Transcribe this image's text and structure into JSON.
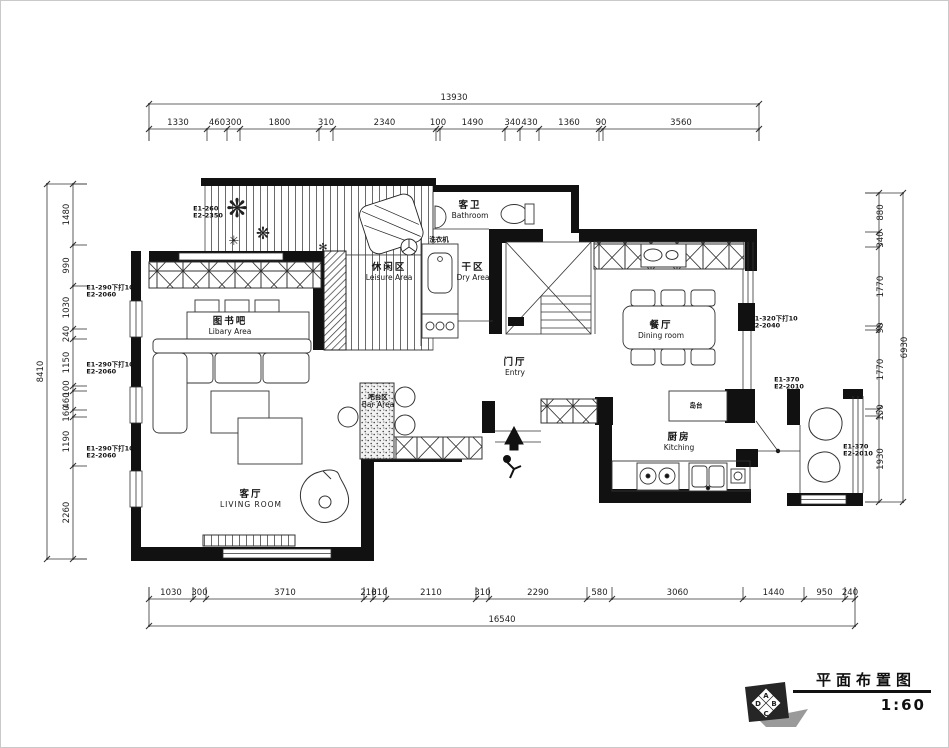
{
  "title_block": {
    "title": "平面布置图",
    "scale_label": "1:60",
    "logo_letters": {
      "top": "A",
      "right": "B",
      "bottom": "C",
      "left": "D"
    }
  },
  "rooms": [
    {
      "id": "bathroom",
      "zh": "客卫",
      "en": "Bathroom",
      "x": 469,
      "y": 210,
      "style": ""
    },
    {
      "id": "dry-area",
      "zh": "干区",
      "en": "Dry Area",
      "x": 472,
      "y": 272,
      "style": ""
    },
    {
      "id": "leisure-area",
      "zh": "休闲区",
      "en": "Leisure Area",
      "x": 388,
      "y": 272,
      "style": ""
    },
    {
      "id": "library-area",
      "zh": "图书吧",
      "en": "Libary Area",
      "x": 229,
      "y": 326,
      "style": ""
    },
    {
      "id": "dining-room",
      "zh": "餐厅",
      "en": "Dining room",
      "x": 660,
      "y": 330,
      "style": ""
    },
    {
      "id": "entry",
      "zh": "门厅",
      "en": "Entry",
      "x": 514,
      "y": 367,
      "style": ""
    },
    {
      "id": "bar-area",
      "zh": "吧台区",
      "en": "Bar Area",
      "x": 377,
      "y": 401,
      "style": "small"
    },
    {
      "id": "living-room",
      "zh": "客厅",
      "en": "LIVING ROOM",
      "x": 250,
      "y": 499,
      "style": "caps"
    },
    {
      "id": "kitchen",
      "zh": "厨房",
      "en": "Kitching",
      "x": 678,
      "y": 442,
      "style": ""
    },
    {
      "id": "island",
      "zh": "岛台",
      "en": "",
      "x": 695,
      "y": 405,
      "style": "small"
    },
    {
      "id": "washer",
      "zh": "洗衣机",
      "en": "",
      "x": 438,
      "y": 239,
      "style": "small"
    }
  ],
  "annotations": [
    {
      "line1": "E1-260",
      "line2": "E2-2350",
      "x": 207,
      "y": 212
    },
    {
      "line1": "E1-290下打10",
      "line2": "E2-2060",
      "x": 109,
      "y": 291
    },
    {
      "line1": "E1-290下打10",
      "line2": "E2-2060",
      "x": 109,
      "y": 368
    },
    {
      "line1": "E1-290下打10",
      "line2": "E2-2060",
      "x": 109,
      "y": 452
    },
    {
      "line1": "E1-320下打10",
      "line2": "E2-2040",
      "x": 773,
      "y": 322
    },
    {
      "line1": "E1-370",
      "line2": "E2-2010",
      "x": 788,
      "y": 383
    },
    {
      "line1": "E1-370",
      "line2": "E2-2010",
      "x": 857,
      "y": 450
    }
  ],
  "dimensions": {
    "top": {
      "overall": "13930",
      "segments": [
        {
          "v": "1330",
          "px": 58
        },
        {
          "v": "460",
          "px": 20
        },
        {
          "v": "300",
          "px": 13
        },
        {
          "v": "1800",
          "px": 79
        },
        {
          "v": "310",
          "px": 14
        },
        {
          "v": "2340",
          "px": 103
        },
        {
          "v": "100",
          "px": 4
        },
        {
          "v": "1490",
          "px": 65
        },
        {
          "v": "340",
          "px": 15
        },
        {
          "v": "430",
          "px": 19
        },
        {
          "v": "1360",
          "px": 60
        },
        {
          "v": "90",
          "px": 4
        },
        {
          "v": "3560",
          "px": 156
        }
      ]
    },
    "bottom": {
      "overall": "16540",
      "segments": [
        {
          "v": "1030",
          "px": 44
        },
        {
          "v": "300",
          "px": 13
        },
        {
          "v": "3710",
          "px": 158
        },
        {
          "v": "210",
          "px": 9
        },
        {
          "v": "310",
          "px": 13
        },
        {
          "v": "2110",
          "px": 90
        },
        {
          "v": "310",
          "px": 13
        },
        {
          "v": "2290",
          "px": 98
        },
        {
          "v": "580",
          "px": 25
        },
        {
          "v": "3060",
          "px": 131
        },
        {
          "v": "1440",
          "px": 61
        },
        {
          "v": "950",
          "px": 41
        },
        {
          "v": "240",
          "px": 10
        }
      ]
    },
    "left": {
      "overall": "8410",
      "segments": [
        {
          "v": "1480",
          "px": 61
        },
        {
          "v": "990",
          "px": 41
        },
        {
          "v": "1030",
          "px": 43
        },
        {
          "v": "240",
          "px": 10
        },
        {
          "v": "1150",
          "px": 47
        },
        {
          "v": "100",
          "px": 5
        },
        {
          "v": "460",
          "px": 19
        },
        {
          "v": "160",
          "px": 7
        },
        {
          "v": "1190",
          "px": 49
        },
        {
          "v": "2260",
          "px": 93
        }
      ]
    },
    "right": {
      "overall": "6930",
      "segments": [
        {
          "v": "880",
          "px": 39
        },
        {
          "v": "340",
          "px": 15
        },
        {
          "v": "1770",
          "px": 79
        },
        {
          "v": "90",
          "px": 4
        },
        {
          "v": "1770",
          "px": 79
        },
        {
          "v": "150",
          "px": 7
        },
        {
          "v": "1930",
          "px": 86
        }
      ]
    }
  }
}
